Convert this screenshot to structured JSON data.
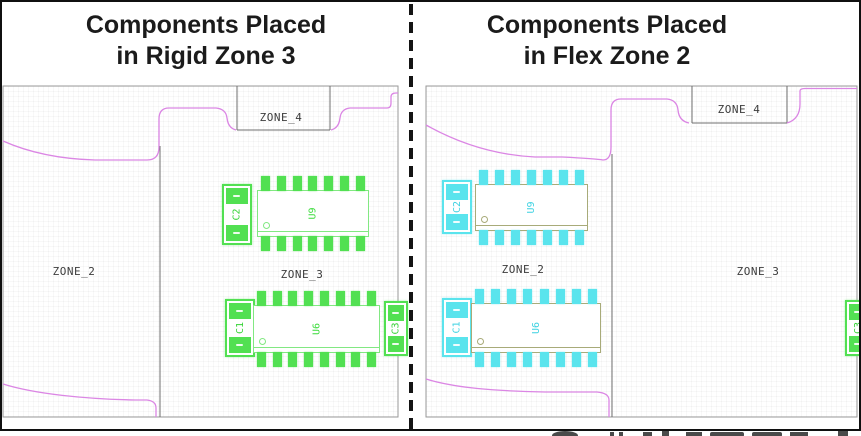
{
  "titles": {
    "left": [
      "Components Placed",
      "in Rigid Zone 3"
    ],
    "right": [
      "Components Placed",
      "in Flex Zone 2"
    ]
  },
  "left_panel": {
    "zone_labels": {
      "zone4": "ZONE_4",
      "zone2": "ZONE_2",
      "zone3": "ZONE_3"
    },
    "components": {
      "cap_top": "C2",
      "ic_top": {
        "label": "U9",
        "pins_per_side": 7
      },
      "cap_bottom": "C1",
      "ic_bottom": {
        "label": "U6",
        "pins_per_side": 8
      },
      "cap_edge": "C3"
    }
  },
  "right_panel": {
    "zone_labels": {
      "zone4": "ZONE_4",
      "zone2": "ZONE_2",
      "zone3": "ZONE_3"
    },
    "components": {
      "cap_top": "C2",
      "ic_top": {
        "label": "U9",
        "pins_per_side": 7
      },
      "cap_bottom": "C1",
      "ic_bottom": {
        "label": "U6",
        "pins_per_side": 8
      },
      "cap_edge": "C3"
    }
  },
  "colors": {
    "rigid_zone_components": "#52e052",
    "flex_zone_components": "#5ae4ed",
    "board_outline": "#db86e4",
    "zone_boundary_lines": "#6f6f6f"
  }
}
